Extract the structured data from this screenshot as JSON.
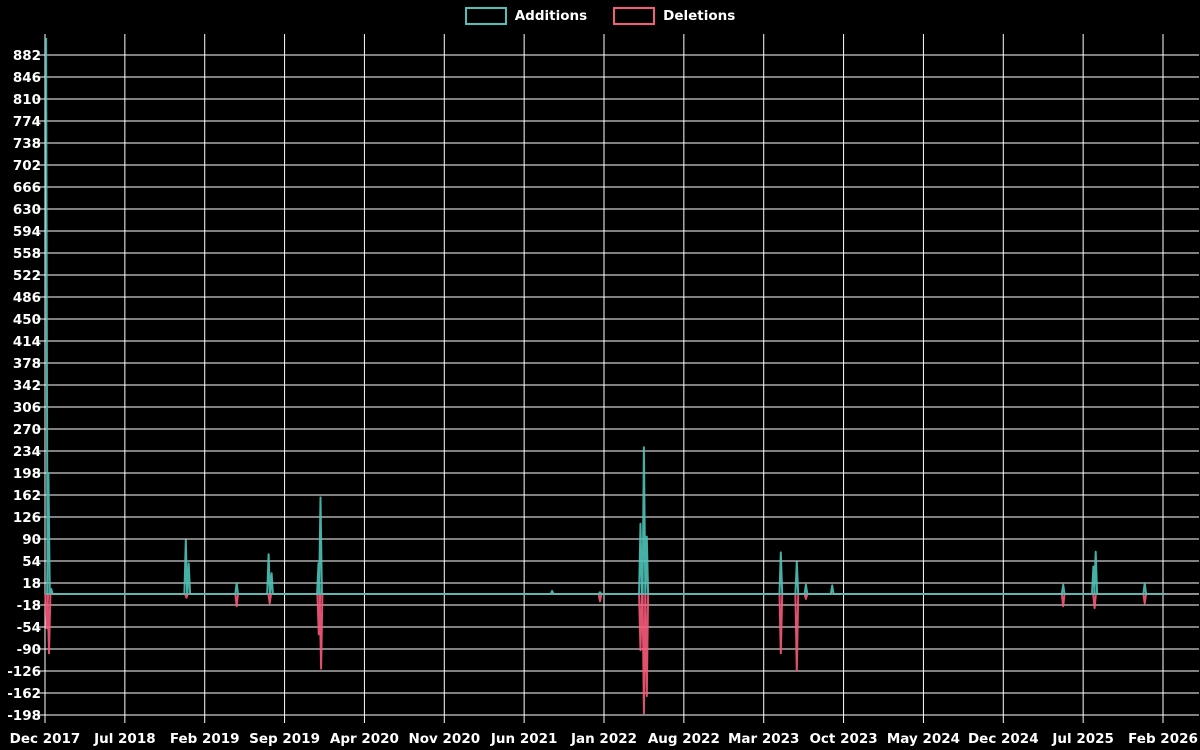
{
  "legend": {
    "items": [
      {
        "label": "Additions",
        "color": "#4ec2b8"
      },
      {
        "label": "Deletions",
        "color": "#f95a7a"
      }
    ]
  },
  "chart_data": {
    "type": "line",
    "title": "",
    "description": "Weekly code additions and deletions over time",
    "x_axis": {
      "unit": "months",
      "tick_interval_months": 7,
      "tick_labels": [
        "Dec 2017",
        "Jul 2018",
        "Feb 2019",
        "Sep 2019",
        "Apr 2020",
        "Nov 2020",
        "Jun 2021",
        "Jan 2022",
        "Aug 2022",
        "Mar 2023",
        "Oct 2023",
        "May 2024",
        "Dec 2024",
        "Jul 2025",
        "Feb 2026"
      ]
    },
    "y_axis": {
      "tick_min": -198,
      "tick_max": 882,
      "tick_step": 36,
      "plot_top_value": 916,
      "plot_bottom_value": -198
    },
    "baseline": 0,
    "series": [
      {
        "name": "Additions",
        "color": "#4ec2b8",
        "start_at_peak": true,
        "points": [
          [
            0.1,
            910
          ],
          [
            0.3,
            198
          ],
          [
            0.55,
            8
          ],
          [
            12.34,
            88
          ],
          [
            12.6,
            50
          ],
          [
            16.8,
            18
          ],
          [
            19.6,
            65
          ],
          [
            19.86,
            34
          ],
          [
            23.97,
            50
          ],
          [
            24.15,
            158
          ],
          [
            44.45,
            5
          ],
          [
            48.65,
            3
          ],
          [
            52.2,
            115
          ],
          [
            52.5,
            240
          ],
          [
            52.75,
            94
          ],
          [
            64.5,
            68
          ],
          [
            65.9,
            52
          ],
          [
            66.7,
            15
          ],
          [
            69.0,
            14
          ],
          [
            89.25,
            15
          ],
          [
            91.9,
            45
          ],
          [
            92.1,
            69
          ],
          [
            96.4,
            18
          ]
        ]
      },
      {
        "name": "Deletions",
        "color": "#f95a7a",
        "start_at_peak": false,
        "points": [
          [
            0.15,
            -56
          ],
          [
            0.35,
            -97
          ],
          [
            12.4,
            -6
          ],
          [
            16.8,
            -20
          ],
          [
            19.7,
            -15
          ],
          [
            24.0,
            -66
          ],
          [
            24.2,
            -122
          ],
          [
            48.65,
            -12
          ],
          [
            52.2,
            -92
          ],
          [
            52.5,
            -195
          ],
          [
            52.75,
            -167
          ],
          [
            64.5,
            -97
          ],
          [
            65.9,
            -126
          ],
          [
            66.7,
            -8
          ],
          [
            89.25,
            -20
          ],
          [
            92.0,
            -23
          ],
          [
            96.4,
            -15
          ]
        ]
      }
    ],
    "colors": {
      "background": "#000000",
      "grid": "#ffffff",
      "zero_line": "#8f8f8f",
      "text": "#ffffff"
    },
    "legend_position": "top-center",
    "grid": true
  }
}
